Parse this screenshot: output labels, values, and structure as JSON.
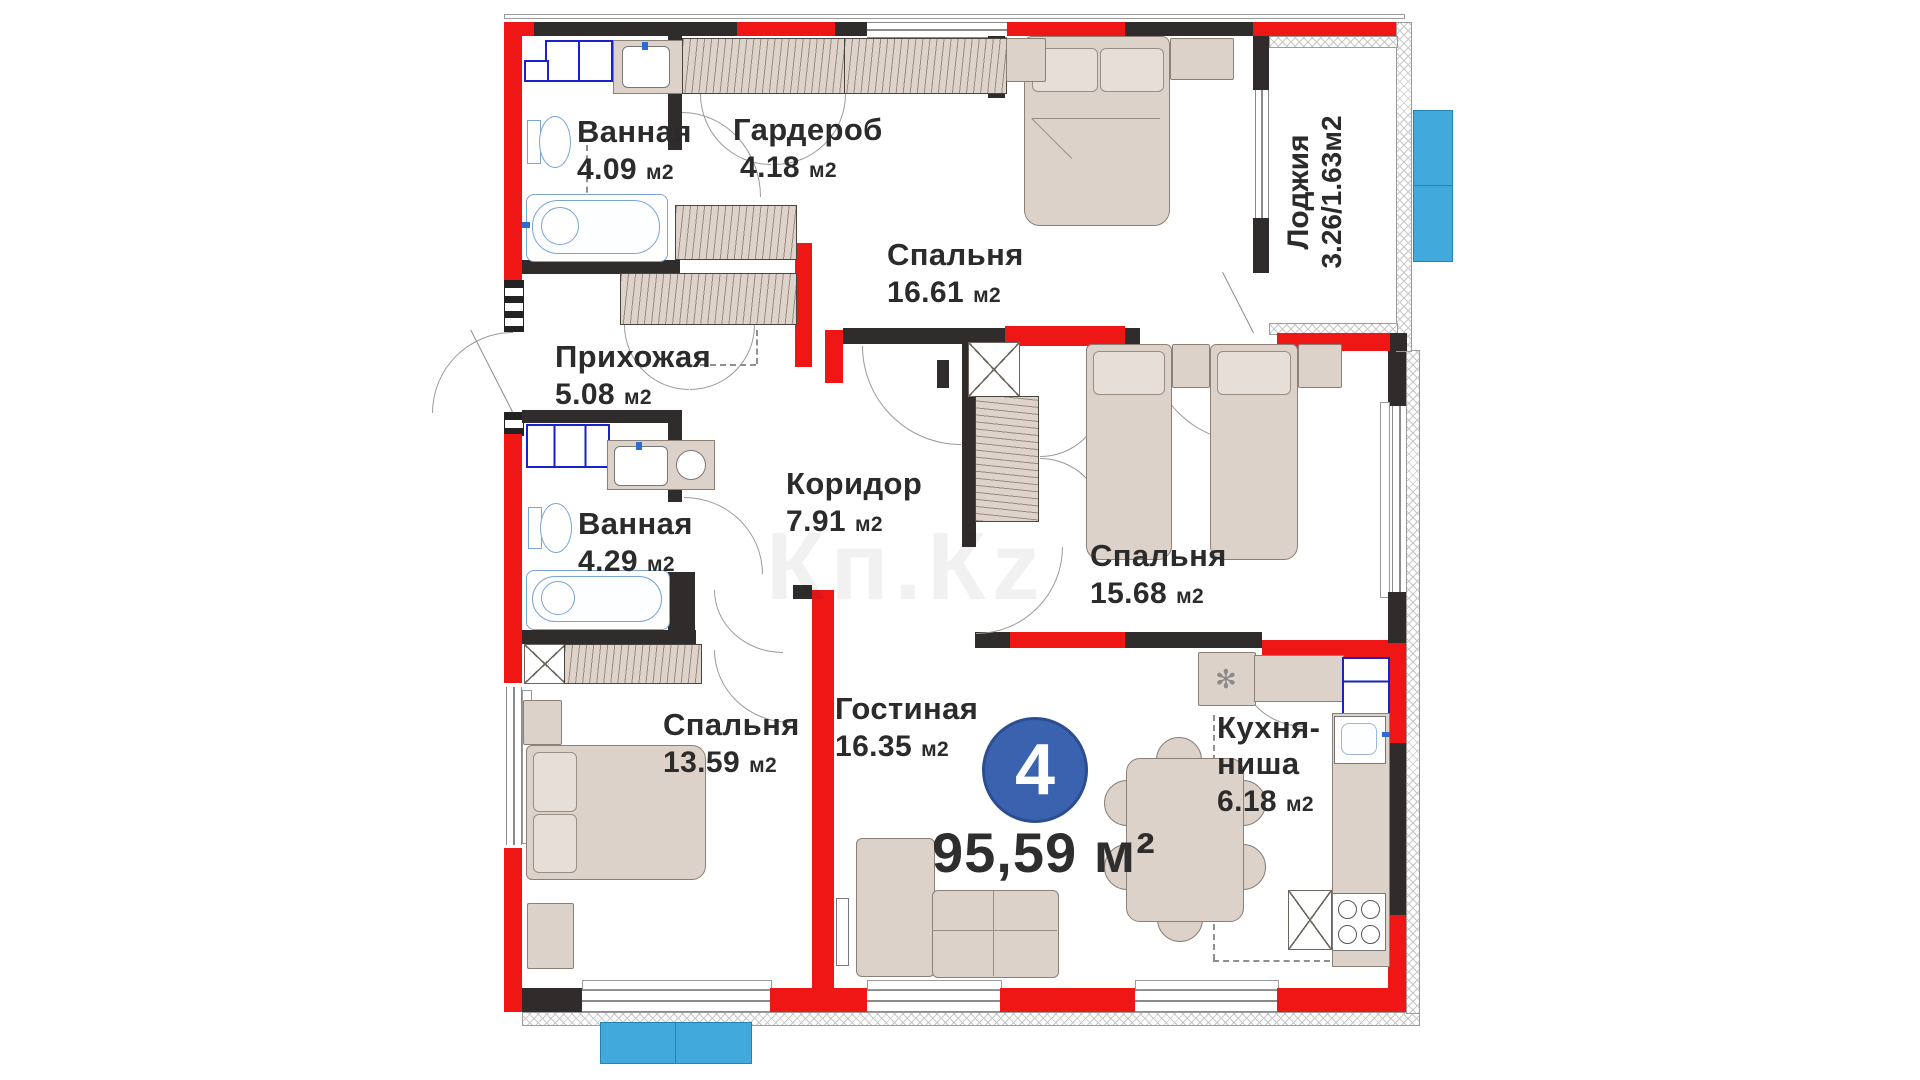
{
  "plan_type": "apartment-floor-plan",
  "rooms": {
    "bath1": {
      "name": "Ванная",
      "area": "4.09",
      "unit": "м2"
    },
    "wardrobe": {
      "name": "Гардероб",
      "area": "4.18",
      "unit": "м2"
    },
    "bedroom_top": {
      "name": "Спальня",
      "area": "16.61",
      "unit": "м2"
    },
    "loggia": {
      "name": "Лоджия",
      "area": "3.26/1.63м2"
    },
    "hallway": {
      "name": "Прихожая",
      "area": "5.08",
      "unit": "м2"
    },
    "corridor": {
      "name": "Коридор",
      "area": "7.91",
      "unit": "м2"
    },
    "bath2": {
      "name": "Ванная",
      "area": "4.29",
      "unit": "м2"
    },
    "bedroom_right": {
      "name": "Спальня",
      "area": "15.68",
      "unit": "м2"
    },
    "bedroom_left": {
      "name": "Спальня",
      "area": "13.59",
      "unit": "м2"
    },
    "living": {
      "name": "Гостиная",
      "area": "16.35",
      "unit": "м2"
    },
    "kitchen": {
      "name_line1": "Кухня-",
      "name_line2": "ниша",
      "area": "6.18",
      "unit": "м2"
    }
  },
  "badge": {
    "number": "4",
    "total_area": "95,59 м²"
  },
  "watermark": "Кп.Кz",
  "icons": {
    "ventilation": "✻"
  },
  "colors": {
    "wall_red": "#ef1616",
    "wall_dark": "#2f2c2b",
    "furniture_beige": "#ddd2ca",
    "plumbing_blue": "#1822c8",
    "sanitary_blue": "#7aa4d6",
    "exterior_blue": "#41a9dc",
    "badge_blue": "#3b62ae",
    "text": "#2b2b2b"
  }
}
